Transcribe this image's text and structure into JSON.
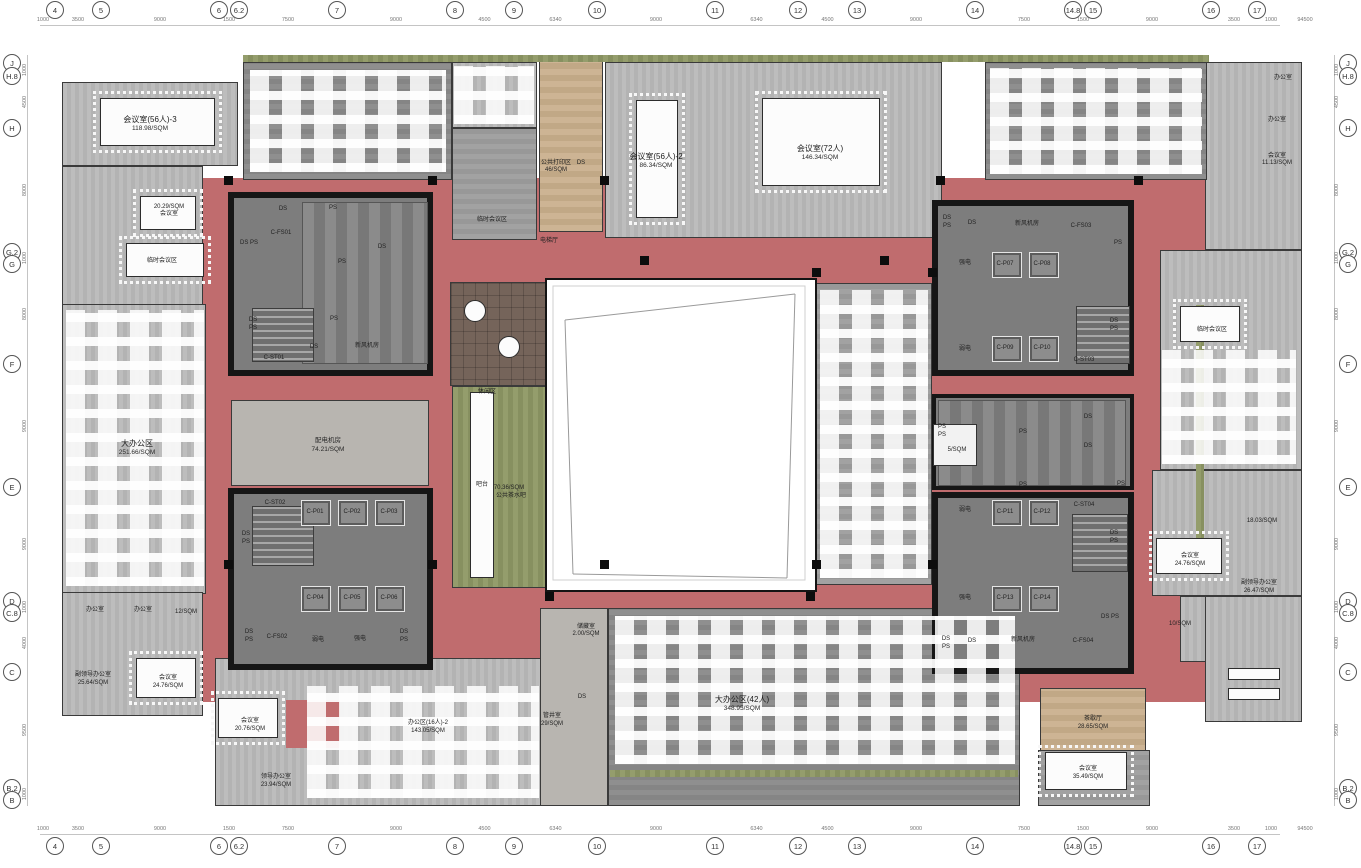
{
  "colors": {
    "corridor": "#c06c6e",
    "core_wall": "#161616",
    "core_floor": "#7d7d7d",
    "floor_light": "#b8b8b8",
    "carpet": "#9a9a9a",
    "green": "#8e9767",
    "tan": "#c9b190",
    "brown": "#75645a",
    "concrete": "#b8b5b0"
  },
  "grid": {
    "total_width": "94500",
    "edge_dim": "1000",
    "top": [
      {
        "l": "4",
        "x": 55
      },
      {
        "l": "5",
        "x": 101
      },
      {
        "l": "6",
        "x": 219
      },
      {
        "l": "6.2",
        "x": 239
      },
      {
        "l": "7",
        "x": 337
      },
      {
        "l": "8",
        "x": 455
      },
      {
        "l": "9",
        "x": 514
      },
      {
        "l": "10",
        "x": 597
      },
      {
        "l": "11",
        "x": 715
      },
      {
        "l": "12",
        "x": 798
      },
      {
        "l": "13",
        "x": 857
      },
      {
        "l": "14",
        "x": 975
      },
      {
        "l": "14.8",
        "x": 1073
      },
      {
        "l": "15",
        "x": 1093
      },
      {
        "l": "16",
        "x": 1211
      },
      {
        "l": "17",
        "x": 1257
      }
    ],
    "top_gaps": [
      "3500",
      "9000",
      "1500",
      "7500",
      "9000",
      "4500",
      "6340",
      "9000",
      "6340",
      "4500",
      "9000",
      "7500",
      "1500",
      "9000",
      "3500"
    ],
    "left": [
      {
        "l": "J",
        "y": 63
      },
      {
        "l": "H.8",
        "y": 76
      },
      {
        "l": "H",
        "y": 128
      },
      {
        "l": "G.2",
        "y": 252
      },
      {
        "l": "G",
        "y": 264
      },
      {
        "l": "F",
        "y": 364
      },
      {
        "l": "E",
        "y": 487
      },
      {
        "l": "D",
        "y": 601
      },
      {
        "l": "C.8",
        "y": 613
      },
      {
        "l": "C",
        "y": 672
      },
      {
        "l": "B.2",
        "y": 788
      },
      {
        "l": "B",
        "y": 800
      }
    ],
    "left_gaps": [
      "1000",
      "4500",
      "8000",
      "1000",
      "8000",
      "9000",
      "9000",
      "1000",
      "4000",
      "9500",
      "1000"
    ]
  },
  "labels": [
    {
      "t": "会议室(56人)-3",
      "x": 150,
      "y": 120,
      "c": "a"
    },
    {
      "t": "118.98/SQM",
      "x": 150,
      "y": 129,
      "c": "b"
    },
    {
      "t": "20.29/SQM",
      "x": 169,
      "y": 207,
      "c": "c"
    },
    {
      "t": "会议室",
      "x": 169,
      "y": 214,
      "c": "c"
    },
    {
      "t": "临时会议区",
      "x": 162,
      "y": 261,
      "c": "c"
    },
    {
      "t": "大办公区",
      "x": 137,
      "y": 444,
      "c": "a"
    },
    {
      "t": "251.66/SQM",
      "x": 137,
      "y": 453,
      "c": "b"
    },
    {
      "t": "公共打印区",
      "x": 556,
      "y": 163,
      "c": "c"
    },
    {
      "t": "46/SQM",
      "x": 556,
      "y": 170,
      "c": "c"
    },
    {
      "t": "DS",
      "x": 581,
      "y": 163,
      "c": "c"
    },
    {
      "t": "电梯厅",
      "x": 549,
      "y": 241,
      "c": "c"
    },
    {
      "t": "临时会议区",
      "x": 492,
      "y": 220,
      "c": "c"
    },
    {
      "t": "会议室(56人)-2",
      "x": 656,
      "y": 157,
      "c": "a"
    },
    {
      "t": "86.34/SQM",
      "x": 656,
      "y": 166,
      "c": "b"
    },
    {
      "t": "会议室(72人)",
      "x": 820,
      "y": 149,
      "c": "a"
    },
    {
      "t": "146.34/SQM",
      "x": 820,
      "y": 158,
      "c": "b"
    },
    {
      "t": "办公室",
      "x": 1283,
      "y": 78,
      "c": "c"
    },
    {
      "t": "办公室",
      "x": 1277,
      "y": 120,
      "c": "c"
    },
    {
      "t": "会议室",
      "x": 1277,
      "y": 156,
      "c": "c"
    },
    {
      "t": "11.13/SQM",
      "x": 1277,
      "y": 163,
      "c": "c"
    },
    {
      "t": "DS",
      "x": 283,
      "y": 209,
      "c": "c"
    },
    {
      "t": "C-FS01",
      "x": 281,
      "y": 233,
      "c": "c"
    },
    {
      "t": "DS PS",
      "x": 249,
      "y": 243,
      "c": "c"
    },
    {
      "t": "PS",
      "x": 333,
      "y": 208,
      "c": "c"
    },
    {
      "t": "DS",
      "x": 382,
      "y": 247,
      "c": "c"
    },
    {
      "t": "PS",
      "x": 342,
      "y": 262,
      "c": "c"
    },
    {
      "t": "DS",
      "x": 253,
      "y": 320,
      "c": "c"
    },
    {
      "t": "PS",
      "x": 253,
      "y": 328,
      "c": "c"
    },
    {
      "t": "PS",
      "x": 334,
      "y": 319,
      "c": "c"
    },
    {
      "t": "DS",
      "x": 314,
      "y": 347,
      "c": "c"
    },
    {
      "t": "C-ST01",
      "x": 274,
      "y": 358,
      "c": "c"
    },
    {
      "t": "新风机房",
      "x": 367,
      "y": 346,
      "c": "c"
    },
    {
      "t": "配电机房",
      "x": 328,
      "y": 441,
      "c": "b"
    },
    {
      "t": "74.21/SQM",
      "x": 328,
      "y": 450,
      "c": "b"
    },
    {
      "t": "C-ST02",
      "x": 275,
      "y": 503,
      "c": "c"
    },
    {
      "t": "C-P01",
      "x": 315,
      "y": 512,
      "c": "c"
    },
    {
      "t": "C-P02",
      "x": 352,
      "y": 512,
      "c": "c"
    },
    {
      "t": "C-P03",
      "x": 389,
      "y": 512,
      "c": "c"
    },
    {
      "t": "DS",
      "x": 246,
      "y": 534,
      "c": "c"
    },
    {
      "t": "PS",
      "x": 246,
      "y": 542,
      "c": "c"
    },
    {
      "t": "C-P04",
      "x": 315,
      "y": 598,
      "c": "c"
    },
    {
      "t": "C-P05",
      "x": 352,
      "y": 598,
      "c": "c"
    },
    {
      "t": "C-P06",
      "x": 389,
      "y": 598,
      "c": "c"
    },
    {
      "t": "DS",
      "x": 249,
      "y": 632,
      "c": "c"
    },
    {
      "t": "PS",
      "x": 249,
      "y": 640,
      "c": "c"
    },
    {
      "t": "C-FS02",
      "x": 277,
      "y": 637,
      "c": "c"
    },
    {
      "t": "弱电",
      "x": 318,
      "y": 640,
      "c": "c"
    },
    {
      "t": "强电",
      "x": 360,
      "y": 639,
      "c": "c"
    },
    {
      "t": "DS",
      "x": 404,
      "y": 632,
      "c": "c"
    },
    {
      "t": "PS",
      "x": 404,
      "y": 640,
      "c": "c"
    },
    {
      "t": "DS",
      "x": 947,
      "y": 218,
      "c": "c"
    },
    {
      "t": "PS",
      "x": 947,
      "y": 226,
      "c": "c"
    },
    {
      "t": "DS",
      "x": 972,
      "y": 223,
      "c": "c"
    },
    {
      "t": "新风机房",
      "x": 1027,
      "y": 224,
      "c": "c"
    },
    {
      "t": "C-FS03",
      "x": 1081,
      "y": 226,
      "c": "c"
    },
    {
      "t": "PS",
      "x": 1118,
      "y": 243,
      "c": "c"
    },
    {
      "t": "强电",
      "x": 965,
      "y": 263,
      "c": "c"
    },
    {
      "t": "C-P07",
      "x": 1005,
      "y": 264,
      "c": "c"
    },
    {
      "t": "C-P08",
      "x": 1042,
      "y": 264,
      "c": "c"
    },
    {
      "t": "DS",
      "x": 1114,
      "y": 321,
      "c": "c"
    },
    {
      "t": "PS",
      "x": 1114,
      "y": 329,
      "c": "c"
    },
    {
      "t": "弱电",
      "x": 965,
      "y": 349,
      "c": "c"
    },
    {
      "t": "C-P09",
      "x": 1005,
      "y": 348,
      "c": "c"
    },
    {
      "t": "C-P10",
      "x": 1042,
      "y": 348,
      "c": "c"
    },
    {
      "t": "C-ST03",
      "x": 1084,
      "y": 360,
      "c": "c"
    },
    {
      "t": "PS",
      "x": 942,
      "y": 427,
      "c": "c"
    },
    {
      "t": "PS",
      "x": 942,
      "y": 435,
      "c": "c"
    },
    {
      "t": "5/SQM",
      "x": 957,
      "y": 450,
      "c": "c"
    },
    {
      "t": "PS",
      "x": 1023,
      "y": 432,
      "c": "c"
    },
    {
      "t": "DS",
      "x": 1088,
      "y": 417,
      "c": "c"
    },
    {
      "t": "DS",
      "x": 1088,
      "y": 446,
      "c": "c"
    },
    {
      "t": "PS",
      "x": 1023,
      "y": 485,
      "c": "c"
    },
    {
      "t": "PS",
      "x": 1121,
      "y": 484,
      "c": "c"
    },
    {
      "t": "弱电",
      "x": 965,
      "y": 510,
      "c": "c"
    },
    {
      "t": "C-P11",
      "x": 1005,
      "y": 512,
      "c": "c"
    },
    {
      "t": "C-P12",
      "x": 1042,
      "y": 512,
      "c": "c"
    },
    {
      "t": "C-ST04",
      "x": 1084,
      "y": 505,
      "c": "c"
    },
    {
      "t": "DS",
      "x": 1114,
      "y": 533,
      "c": "c"
    },
    {
      "t": "PS",
      "x": 1114,
      "y": 541,
      "c": "c"
    },
    {
      "t": "强电",
      "x": 965,
      "y": 598,
      "c": "c"
    },
    {
      "t": "C-P13",
      "x": 1005,
      "y": 598,
      "c": "c"
    },
    {
      "t": "C-P14",
      "x": 1042,
      "y": 598,
      "c": "c"
    },
    {
      "t": "DS PS",
      "x": 1110,
      "y": 617,
      "c": "c"
    },
    {
      "t": "DS",
      "x": 946,
      "y": 639,
      "c": "c"
    },
    {
      "t": "PS",
      "x": 946,
      "y": 647,
      "c": "c"
    },
    {
      "t": "DS",
      "x": 972,
      "y": 641,
      "c": "c"
    },
    {
      "t": "新风机房",
      "x": 1023,
      "y": 640,
      "c": "c"
    },
    {
      "t": "C-FS04",
      "x": 1083,
      "y": 641,
      "c": "c"
    },
    {
      "t": "休闲区",
      "x": 487,
      "y": 392,
      "c": "c"
    },
    {
      "t": "吧台",
      "x": 482,
      "y": 485,
      "c": "c"
    },
    {
      "t": "70.36/SQM",
      "x": 509,
      "y": 488,
      "c": "c"
    },
    {
      "t": "公共茶水吧",
      "x": 511,
      "y": 496,
      "c": "c"
    },
    {
      "t": "临时会议区",
      "x": 1212,
      "y": 330,
      "c": "c"
    },
    {
      "t": "18.03/SQM",
      "x": 1262,
      "y": 521,
      "c": "c"
    },
    {
      "t": "会议室",
      "x": 1190,
      "y": 556,
      "c": "c"
    },
    {
      "t": "24.76/SQM",
      "x": 1190,
      "y": 564,
      "c": "c"
    },
    {
      "t": "副领导办公室",
      "x": 1259,
      "y": 583,
      "c": "c"
    },
    {
      "t": "26.47/SQM",
      "x": 1259,
      "y": 591,
      "c": "c"
    },
    {
      "t": "10/SQM",
      "x": 1180,
      "y": 624,
      "c": "c"
    },
    {
      "t": "办公室",
      "x": 95,
      "y": 610,
      "c": "c"
    },
    {
      "t": "办公室",
      "x": 143,
      "y": 610,
      "c": "c"
    },
    {
      "t": "12/SQM",
      "x": 186,
      "y": 612,
      "c": "c"
    },
    {
      "t": "副领导办公室",
      "x": 93,
      "y": 675,
      "c": "c"
    },
    {
      "t": "25.64/SQM",
      "x": 93,
      "y": 683,
      "c": "c"
    },
    {
      "t": "会议室",
      "x": 168,
      "y": 678,
      "c": "c"
    },
    {
      "t": "24.76/SQM",
      "x": 168,
      "y": 686,
      "c": "c"
    },
    {
      "t": "储藏室",
      "x": 586,
      "y": 627,
      "c": "c"
    },
    {
      "t": "2.00/SQM",
      "x": 586,
      "y": 634,
      "c": "c"
    },
    {
      "t": "DS",
      "x": 582,
      "y": 697,
      "c": "c"
    },
    {
      "t": "管井室",
      "x": 552,
      "y": 716,
      "c": "c"
    },
    {
      "t": "29/SQM",
      "x": 552,
      "y": 724,
      "c": "c"
    },
    {
      "t": "大办公区(42人)",
      "x": 742,
      "y": 700,
      "c": "a"
    },
    {
      "t": "348.95/SQM",
      "x": 742,
      "y": 709,
      "c": "b"
    },
    {
      "t": "会议室",
      "x": 250,
      "y": 721,
      "c": "c"
    },
    {
      "t": "20.76/SQM",
      "x": 250,
      "y": 729,
      "c": "c"
    },
    {
      "t": "办公区(16人)-2",
      "x": 428,
      "y": 723,
      "c": "c"
    },
    {
      "t": "143.05/SQM",
      "x": 428,
      "y": 731,
      "c": "c"
    },
    {
      "t": "领导办公室",
      "x": 276,
      "y": 777,
      "c": "c"
    },
    {
      "t": "23.94/SQM",
      "x": 276,
      "y": 785,
      "c": "c"
    },
    {
      "t": "茶歇厅",
      "x": 1093,
      "y": 719,
      "c": "c"
    },
    {
      "t": "28.65/SQM",
      "x": 1093,
      "y": 727,
      "c": "c"
    },
    {
      "t": "会议室",
      "x": 1088,
      "y": 769,
      "c": "c"
    },
    {
      "t": "35.49/SQM",
      "x": 1088,
      "y": 777,
      "c": "c"
    }
  ]
}
